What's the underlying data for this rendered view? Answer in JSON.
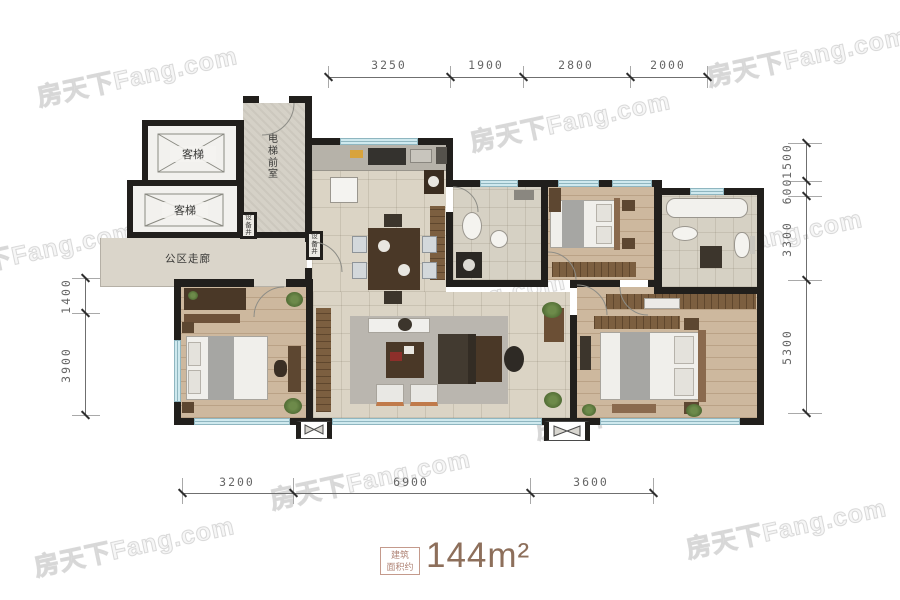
{
  "watermark": {
    "text": "房天下Fang.com"
  },
  "plan": {
    "labels": {
      "elevator_a": "客梯",
      "elevator_b": "客梯",
      "lobby": "电梯前室",
      "shaft_a": "设备井",
      "shaft_b": "设备井",
      "corridor": "公区走廊"
    }
  },
  "dimensions": {
    "top": [
      "3250",
      "1900",
      "2800",
      "2000"
    ],
    "bottom": [
      "3200",
      "6900",
      "3600"
    ],
    "left": [
      "1400",
      "3900"
    ],
    "right": [
      "1500",
      "600",
      "3300",
      "5300"
    ]
  },
  "area": {
    "tag_line1": "建筑",
    "tag_line2": "面积约",
    "value": "144m²"
  },
  "colors": {
    "wall": "#211f1c",
    "window": "#cfe9ee",
    "tile": "#dbd4c5",
    "wood": "#cdb89e",
    "accent": "#8d6f5b"
  }
}
